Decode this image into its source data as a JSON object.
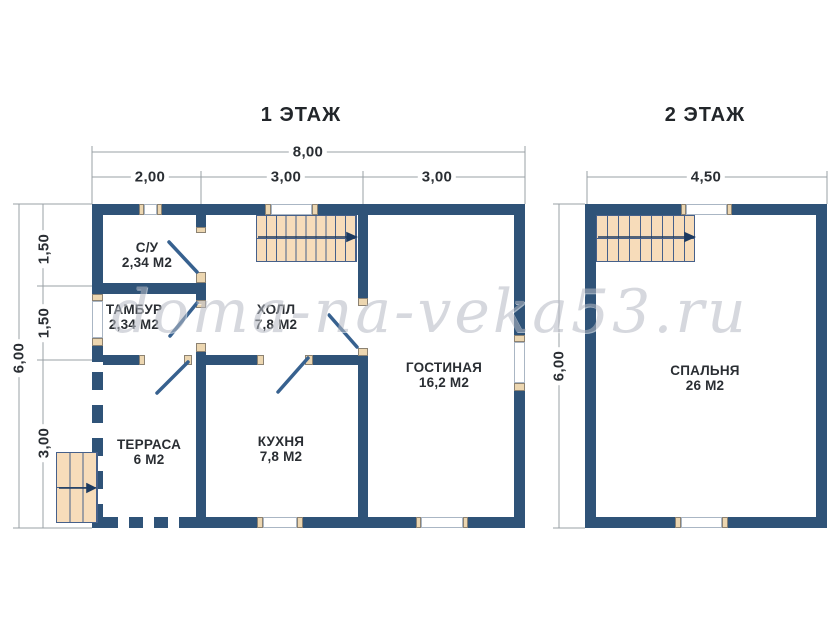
{
  "titles": {
    "floor1": "1 ЭТАЖ",
    "floor2": "2 ЭТАЖ"
  },
  "watermark": "doma-na-veka53.ru",
  "floor1": {
    "dimensions": {
      "width_total": "8,00",
      "width_segments": [
        "2,00",
        "3,00",
        "3,00"
      ],
      "height_total": "6,00",
      "height_segments": [
        "1,50",
        "1,50",
        "3,00"
      ]
    },
    "rooms": {
      "su": {
        "name": "С/У",
        "area": "2,34 М2"
      },
      "tambur": {
        "name": "ТАМБУР",
        "area": "2,34 М2"
      },
      "holl": {
        "name": "ХОЛЛ",
        "area": "7,8 М2"
      },
      "gostinaya": {
        "name": "ГОСТИНАЯ",
        "area": "16,2 М2"
      },
      "terrasa": {
        "name": "ТЕРРАСА",
        "area": "6 М2"
      },
      "kuhnya": {
        "name": "КУХНЯ",
        "area": "7,8 М2"
      }
    }
  },
  "floor2": {
    "dimensions": {
      "width_total": "4,50",
      "height_total": "6,00"
    },
    "rooms": {
      "spalnya": {
        "name": "СПАЛЬНЯ",
        "area": "26 М2"
      }
    }
  },
  "colors": {
    "wall": "#2f5378",
    "stairs_fill": "#f7dcba",
    "jamb_fill": "#ecd6b0",
    "window": "#ffffff",
    "dimension_line": "#9aa0a6",
    "text": "#2a2e33",
    "watermark": "#b6bac4"
  }
}
